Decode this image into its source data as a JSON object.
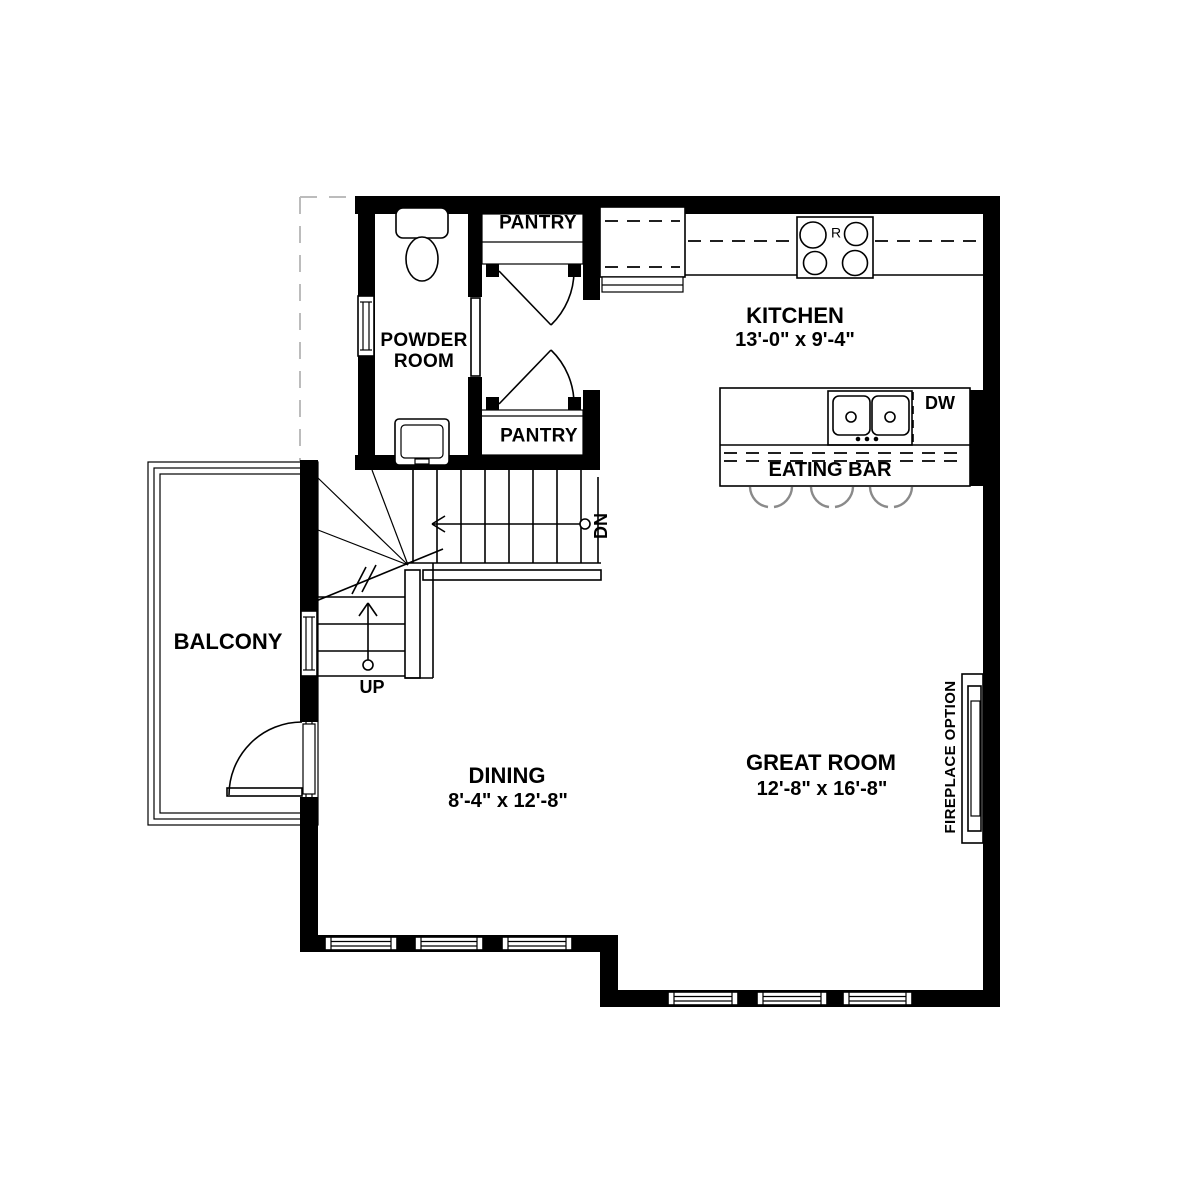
{
  "labels": {
    "powder_room": "POWDER ROOM",
    "pantry_upper": "PANTRY",
    "pantry_lower": "PANTRY",
    "kitchen": "KITCHEN",
    "kitchen_dims": "13'-0\" x 9'-4\"",
    "dishwasher": "DW",
    "range": "R",
    "eating_bar": "EATING BAR",
    "balcony": "BALCONY",
    "dining": "DINING",
    "dining_dims": "8'-4\" x 12'-8\"",
    "great_room": "GREAT ROOM",
    "great_room_dims": "12'-8\" x 16'-8\"",
    "fireplace_option": "FIREPLACE OPTION",
    "stair_up": "UP",
    "stair_down": "DN"
  },
  "colors": {
    "background": "#ffffff",
    "wall": "#000000",
    "stool_arc": "#8a8a8a",
    "projection_line": "#bcbcbc"
  }
}
